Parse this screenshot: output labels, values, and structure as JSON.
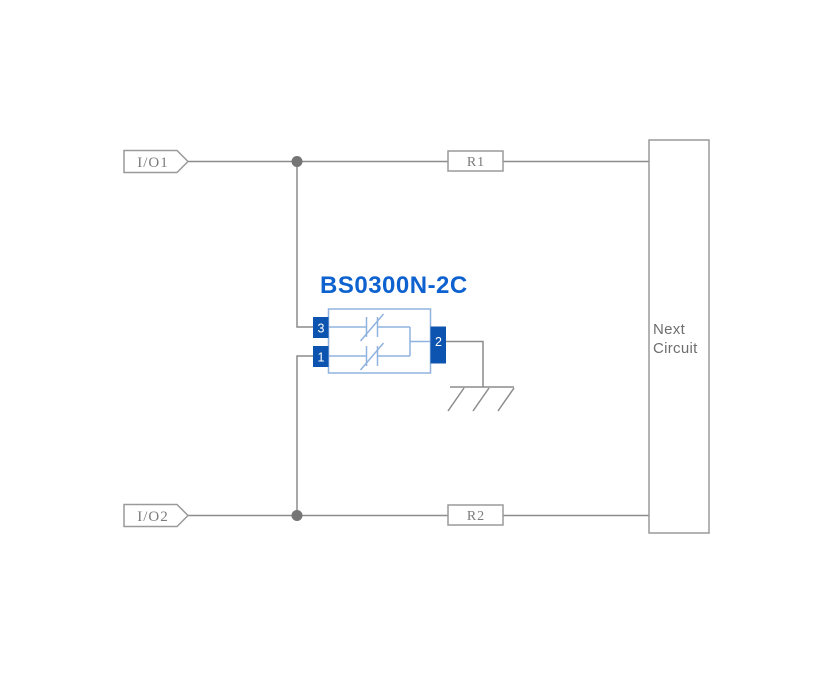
{
  "diagram": {
    "component": {
      "name": "BS0300N-2C",
      "pins": [
        {
          "number": "3"
        },
        {
          "number": "1"
        },
        {
          "number": "2"
        }
      ]
    },
    "connectors": [
      {
        "label": "I/O1"
      },
      {
        "label": "I/O2"
      }
    ],
    "resistors": [
      {
        "label": "R1"
      },
      {
        "label": "R2"
      }
    ],
    "next_circuit": {
      "line1": "Next",
      "line2": "Circuit"
    },
    "icons": {
      "io_connector": "pentagon-flag-shape",
      "junction": "filled-circle-node",
      "tvs_diode": "parallel-bars-with-diagonal-slash",
      "ground": "hatched-earth-ground-symbol"
    }
  },
  "colors": {
    "background": "#ffffff",
    "accent_blue": "#0e62cf",
    "pin_blue": "#0d53b0",
    "component_outline_blue": "#8fb3de",
    "wire_gray": "#8c8c8c",
    "box_stroke_gray": "#9a9a9a",
    "label_gray": "#7b7b7b",
    "text_gray": "#6e6e6e",
    "junction_gray": "#757575"
  }
}
